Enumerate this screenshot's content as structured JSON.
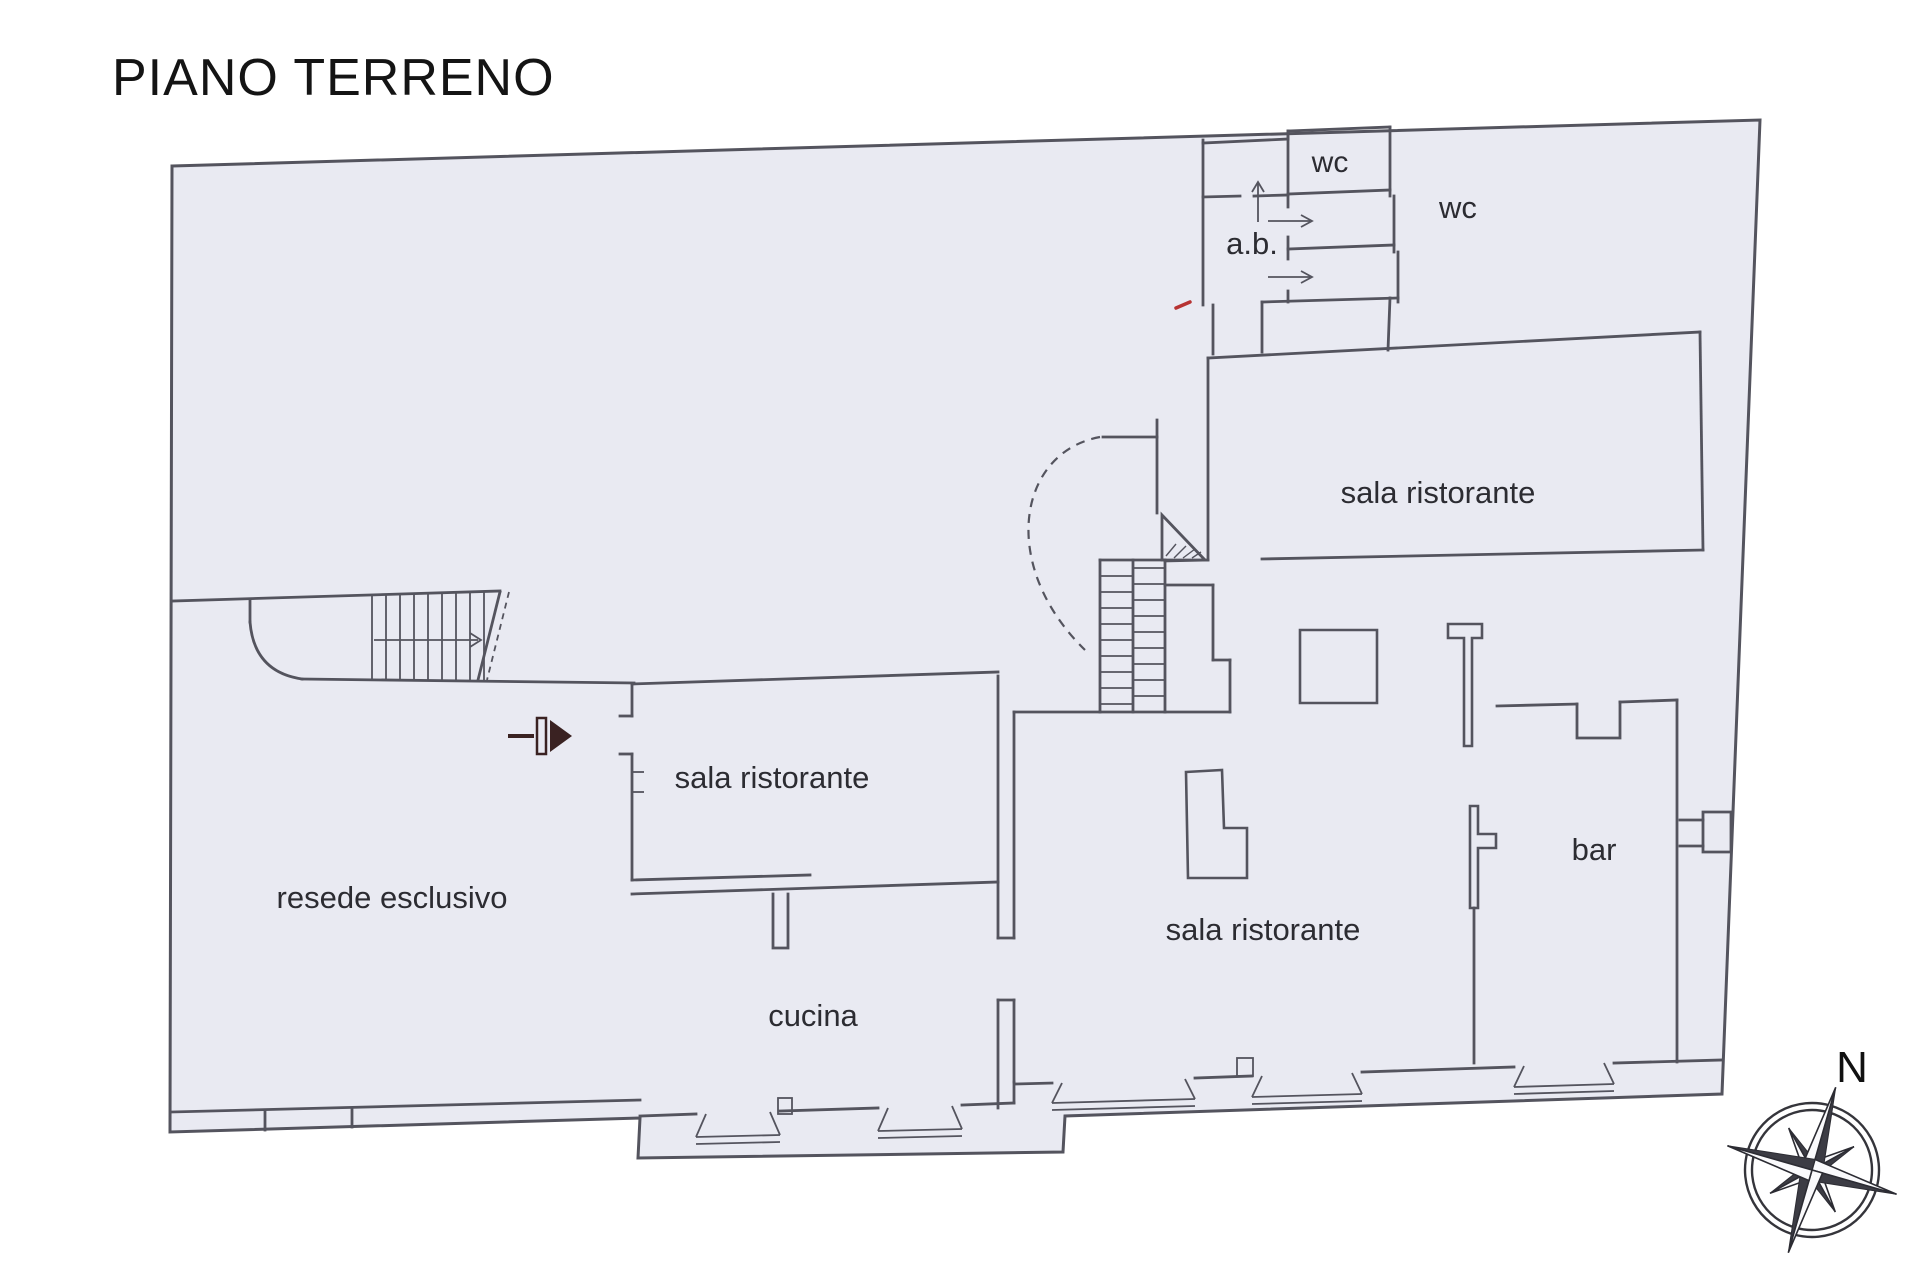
{
  "title": "PIANO TERRENO",
  "compass": {
    "north_label": "N"
  },
  "rooms": {
    "wc_top": "wc",
    "wc_right": "wc",
    "anti_bagno": "a.b.",
    "sala_ristorante_nord": "sala ristorante",
    "sala_ristorante_ovest": "sala ristorante",
    "sala_ristorante_centrale": "sala ristorante",
    "bar": "bar",
    "cucina": "cucina",
    "resede_esclusivo": "resede esclusivo"
  },
  "colors": {
    "background": "#ffffff",
    "plan_fill": "#e9eaf2",
    "wall_line": "#54545e",
    "label_text": "#2c2c32",
    "title_text": "#141414",
    "entry_marker": "#3a2222",
    "red_scan_mark": "#b73333",
    "compass_dark": "#3c3c44"
  }
}
